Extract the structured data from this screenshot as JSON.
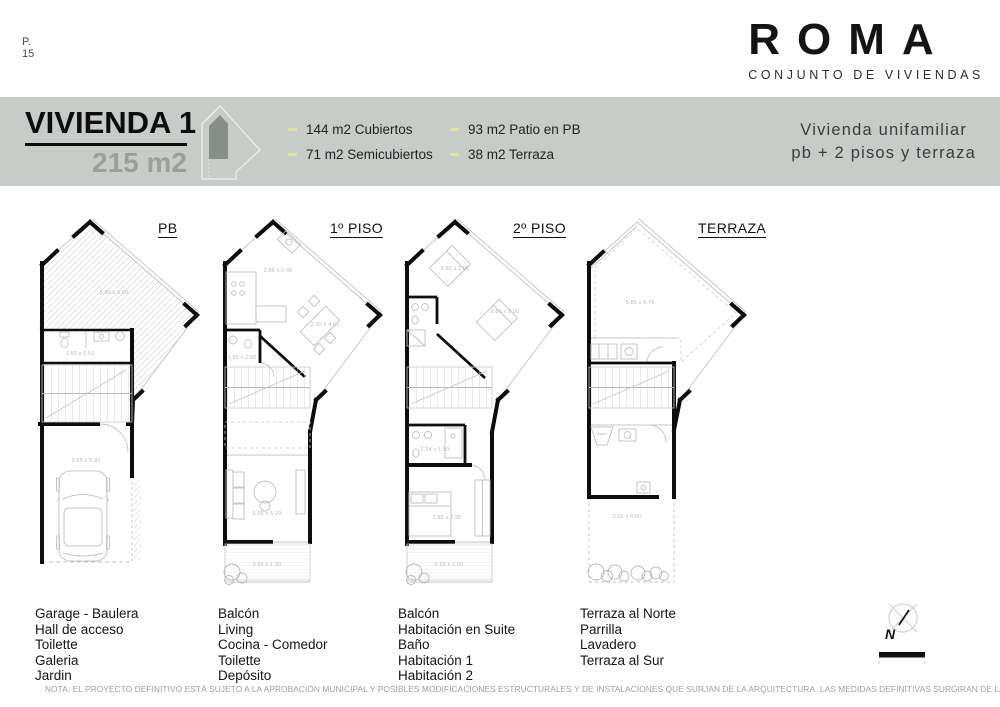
{
  "page": {
    "number_label": "P.",
    "number": "15"
  },
  "brand": {
    "name": "ROMA",
    "subtitle": "CONJUNTO DE VIVIENDAS"
  },
  "header": {
    "title": "VIVIENDA 1",
    "area": "215 m2",
    "band_color": "#c8ccc8",
    "bullet_color": "#e2e29c",
    "bullets": [
      "144 m2 Cubiertos",
      "71 m2 Semicubiertos",
      "93 m2 Patio en PB",
      "38 m2 Terraza"
    ],
    "description_line1": "Vivienda unifamiliar",
    "description_line2": "pb + 2 pisos y terraza"
  },
  "plans": [
    {
      "label": "PB",
      "rooms": [
        "Garage - Baulera",
        "Hall de acceso",
        "Toilette",
        "Galeria",
        "Jardin"
      ],
      "dims": {
        "patio": "5.86 x 3.00",
        "toilette": "1.50 x 2.53",
        "garage": "3.65 x 5.90"
      }
    },
    {
      "label": "1º PISO",
      "rooms": [
        "Balcón",
        "Living",
        "Cocina - Comedor",
        "Toilette",
        "Depósito"
      ],
      "dims": {
        "cocina": "2.86 x 2.40",
        "comedor": "2.30 x 4.00",
        "toilette": "1.50 x 2.50",
        "living": "3.65 x 5.20",
        "balcon": "3.65 x 1.50"
      }
    },
    {
      "label": "2º PISO",
      "rooms": [
        "Balcón",
        "Habitación en Suite",
        "Baño",
        "Habitación 1",
        "Habitación 2"
      ],
      "dims": {
        "habitacion_1": "2.80 x 2.90",
        "habitacion_2": "2.80 x 2.90",
        "bano": "2.54 x 1.50",
        "suite": "3.65 x 2.95",
        "balcon": "3.65 x 1.50"
      }
    },
    {
      "label": "TERRAZA",
      "rooms": [
        "Terraza al Norte",
        "Parrilla",
        "Lavadero",
        "Terraza al Sur"
      ],
      "dims": {
        "terraza_norte": "5.86 x 5.76",
        "terraza_sur": "3.65 x 6.60"
      }
    }
  ],
  "compass": {
    "letter": "N"
  },
  "note": "NOTA: EL PROYECTO DEFINITIVO ESTÁ SUJETO A LA APROBACIÓN MUNICIPAL Y POSIBLES MODIFICACIONES ESTRUCTURALES Y DE INSTALACIONES QUE SURJAN DE LA ARQUITECTURA. LAS MEDIDAS DEFINITIVAS SURGIRAN DE LA OBRA TERMINADA"
}
